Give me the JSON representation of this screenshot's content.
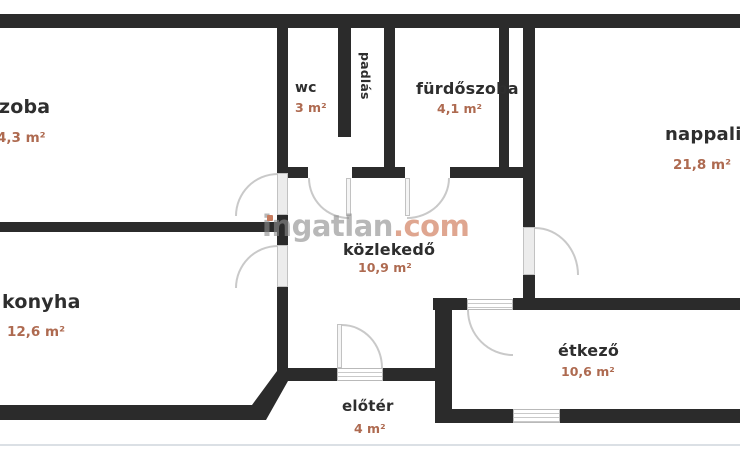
{
  "plan": {
    "watermark": {
      "brand": "ingatlan",
      "tld": ".com"
    },
    "rooms": {
      "szoba": {
        "name": "zoba",
        "area": "4,3 m²"
      },
      "wc": {
        "name": "wc",
        "area": "3 m²"
      },
      "padlas": {
        "name": "padlás"
      },
      "furdoszoba": {
        "name": "fürdőszoba",
        "area": "4,1 m²"
      },
      "nappali": {
        "name": "nappali",
        "area": "21,8 m²"
      },
      "konyha": {
        "name": "konyha",
        "area": "12,6 m²"
      },
      "kozlekedo": {
        "name": "közlekedő",
        "area": "10,9 m²"
      },
      "etkezo": {
        "name": "étkező",
        "area": "10,6 m²"
      },
      "eloter": {
        "name": "előtér",
        "area": "4 m²"
      }
    },
    "colors": {
      "wall": "#2b2b2b",
      "room_label": "#2e2e2e",
      "area_label": "#ae6a50",
      "watermark_gray": "#8c8c8c",
      "watermark_accent": "#d68d71"
    }
  }
}
